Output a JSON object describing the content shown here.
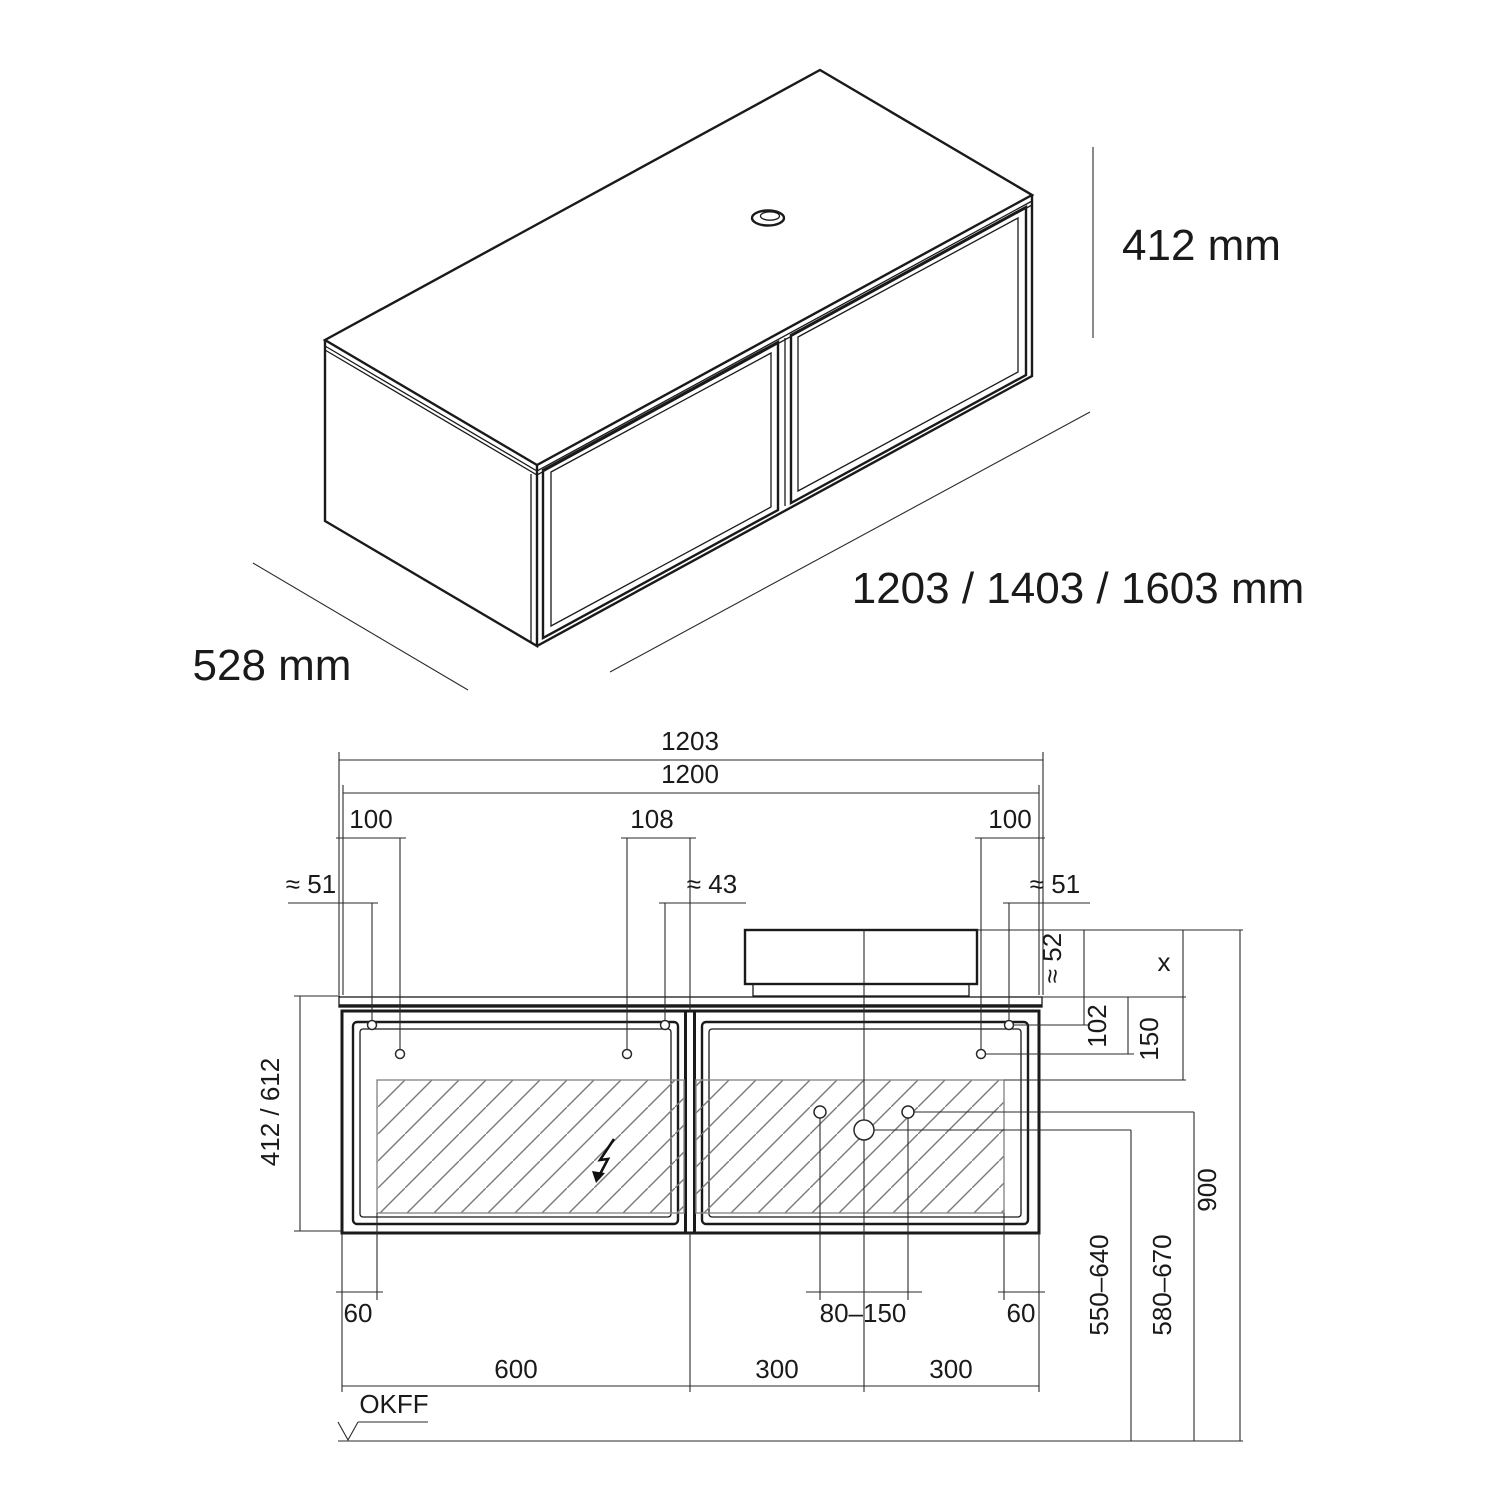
{
  "iso_view": {
    "height_label": "412 mm",
    "depth_label": "528 mm",
    "width_label": "1203 / 1403 / 1603 mm"
  },
  "elevation_view": {
    "width_dims": {
      "overall": "1203",
      "cabinet": "1200",
      "left_hole_offset": "100",
      "center_hole_offset": "108",
      "right_hole_offset": "100",
      "left_hole_approx": "≈ 51",
      "center_hole_approx": "≈ 43",
      "right_hole_approx": "≈ 51"
    },
    "height_dims": {
      "cabinet_heights": "412 / 612",
      "basin_rim_to_hole": "≈ 52",
      "basin_height": "x",
      "counter_to_hole": "102",
      "counter_to_zone": "150",
      "floor_to_rim": "900",
      "lower_range": "550–640",
      "upper_range": "580–670"
    },
    "bottom_dims": {
      "left_inset": "60",
      "drain_offset_range": "80–150",
      "right_inset": "60",
      "left_section": "600",
      "center_section": "300",
      "right_section": "300"
    },
    "datum_label": "OKFF"
  }
}
